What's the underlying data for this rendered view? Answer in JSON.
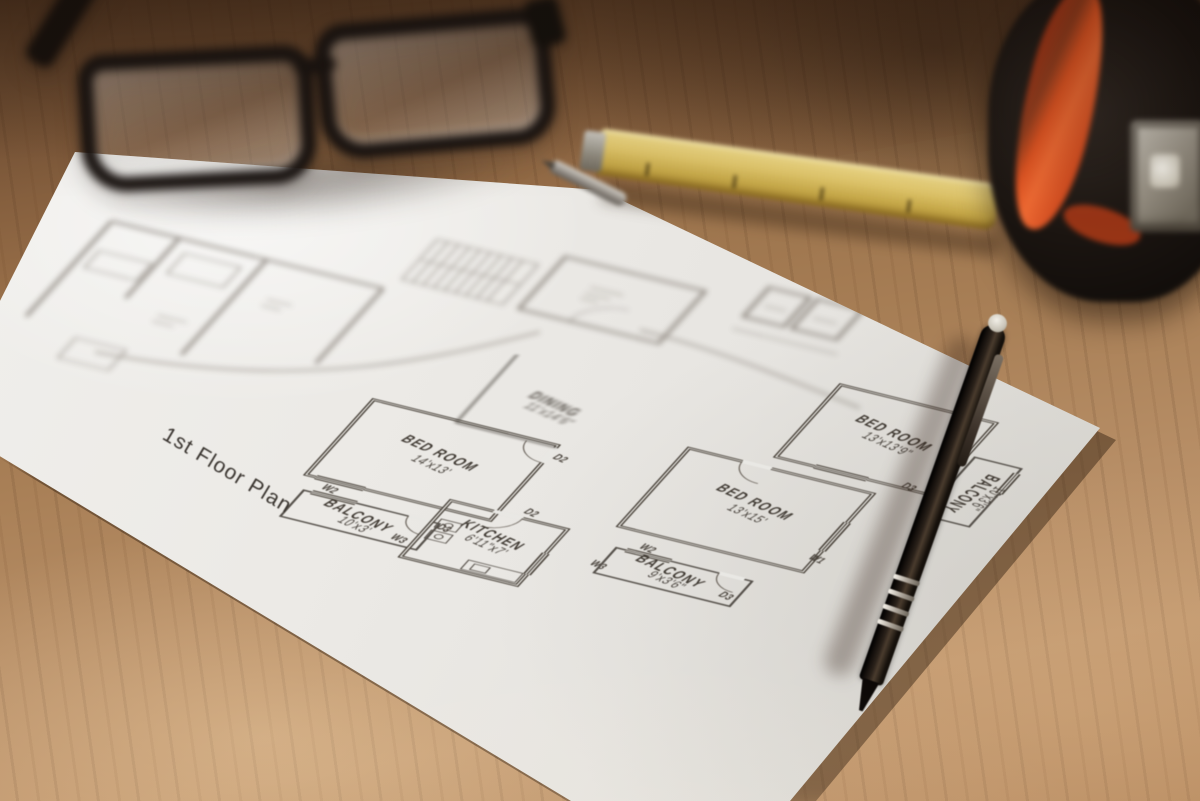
{
  "scene": {
    "objects": {
      "table": "wooden-table",
      "paper": "floor-plan-sheet",
      "glasses": "eyeglasses",
      "ruler": "yellow-folding-ruler",
      "pencil": "metal-pencil",
      "tape": "tape-measure",
      "pen": "black-pen"
    },
    "colors": {
      "wood": "#a87f56",
      "wood_dark": "#5f422b",
      "wood_light": "#c29970",
      "paper": "#e9e8e4",
      "plan_line": "#474038",
      "ruler_yellow": "#dec46a",
      "tape_orange": "#e25522",
      "tape_black": "#1a1410",
      "pen_black": "#15100b"
    }
  },
  "plan": {
    "title": "1st Floor Plan",
    "rooms": [
      {
        "name": "BED ROOM",
        "dims": "14'x13'"
      },
      {
        "name": "BALCONY",
        "dims": "10'x3'"
      },
      {
        "name": "KITCHEN",
        "dims": "6'11\"x7'"
      },
      {
        "name": "DINING",
        "dims": "11'x14'6\""
      },
      {
        "name": "BED ROOM",
        "dims": "13'x15'"
      },
      {
        "name": "BALCONY",
        "dims": "9'x3'6\""
      },
      {
        "name": "BED ROOM",
        "dims": "13'x13'9\""
      },
      {
        "name": "BALCONY",
        "dims": "10'x3'6\""
      }
    ],
    "markers": {
      "w1": "W1",
      "w2": "W2",
      "w3": "W3",
      "d2": "D2",
      "d3": "D3"
    }
  }
}
